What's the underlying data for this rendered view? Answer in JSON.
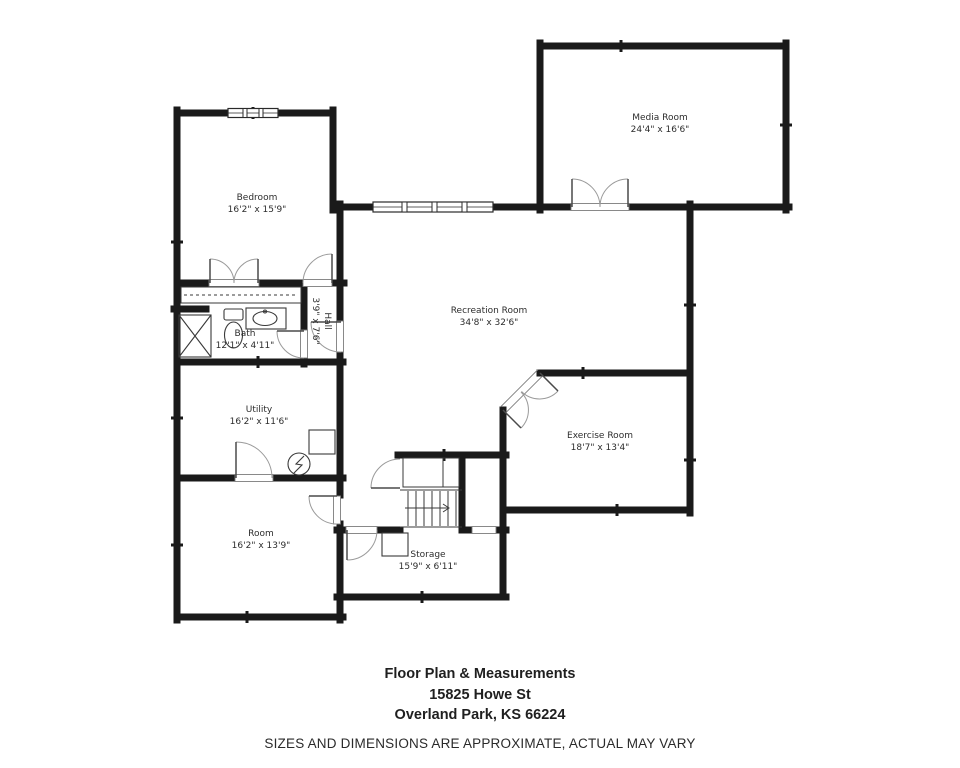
{
  "meta": {
    "background_color": "#ffffff",
    "wall_color": "#1a1a1a",
    "door_arc_color": "#9a9a9a",
    "thin_line_color": "#3a3a3a"
  },
  "rooms": [
    {
      "id": "media-room",
      "name": "Media Room",
      "dims": "24'4\" x 16'6\"",
      "x": 660,
      "y": 124,
      "rotated": false
    },
    {
      "id": "bedroom",
      "name": "Bedroom",
      "dims": "16'2\" x 15'9\"",
      "x": 257,
      "y": 204,
      "rotated": false
    },
    {
      "id": "recreation-room",
      "name": "Recreation Room",
      "dims": "34'8\" x 32'6\"",
      "x": 489,
      "y": 317,
      "rotated": false
    },
    {
      "id": "hall",
      "name": "Hall",
      "dims": "3'9\" x 7'6\"",
      "x": 321,
      "y": 321,
      "rotated": true
    },
    {
      "id": "bath",
      "name": "Bath",
      "dims": "12'1\" x 4'11\"",
      "x": 245,
      "y": 340,
      "rotated": false
    },
    {
      "id": "utility",
      "name": "Utility",
      "dims": "16'2\" x 11'6\"",
      "x": 259,
      "y": 416,
      "rotated": false
    },
    {
      "id": "exercise-room",
      "name": "Exercise Room",
      "dims": "18'7\" x 13'4\"",
      "x": 600,
      "y": 442,
      "rotated": false
    },
    {
      "id": "room",
      "name": "Room",
      "dims": "16'2\" x 13'9\"",
      "x": 261,
      "y": 540,
      "rotated": false
    },
    {
      "id": "storage",
      "name": "Storage",
      "dims": "15'9\" x 6'11\"",
      "x": 428,
      "y": 561,
      "rotated": false
    }
  ],
  "footer": {
    "title": "Floor Plan & Measurements",
    "address_line1": "15825 Howe St",
    "address_line2": "Overland Park, KS 66224",
    "disclaimer": "SIZES AND DIMENSIONS ARE APPROXIMATE, ACTUAL MAY VARY"
  }
}
